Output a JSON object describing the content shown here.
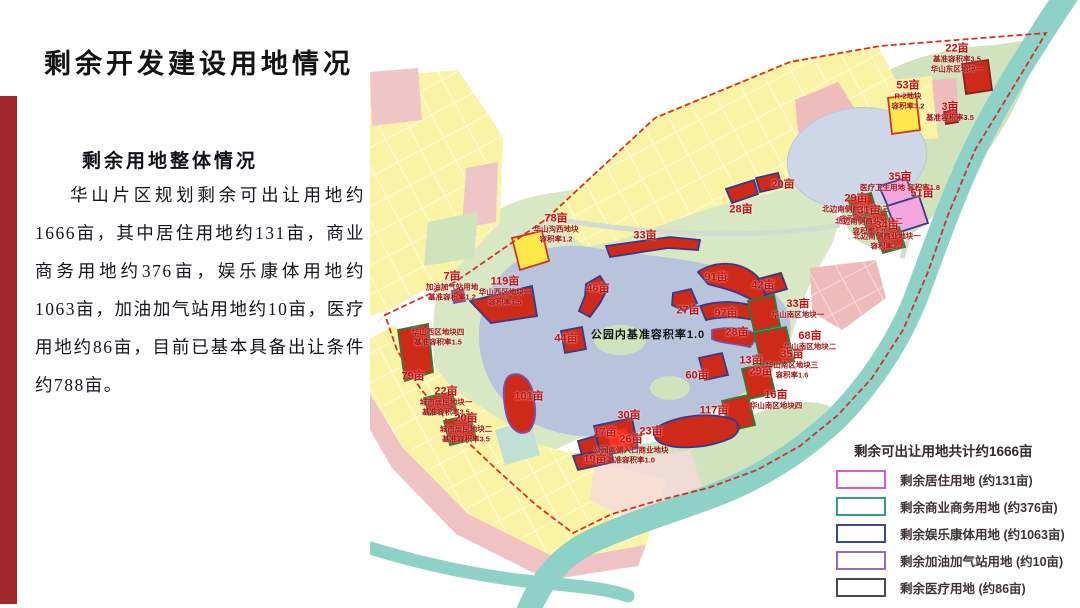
{
  "slide": {
    "title": "剩余开发建设用地情况",
    "subtitle": "剩余用地整体情况",
    "body": "华山片区规划剩余可出让用地约1666亩，其中居住用地约131亩，商业商务用地约376亩，娱乐康体用地约1063亩，加油加气站用地约10亩，医疗用地约86亩，目前已基本具备出让条件约788亩。"
  },
  "map": {
    "center_note": "公园内基准容积率1.0",
    "colors": {
      "remaining_parcel_fill": "#ce2a1a",
      "boundary_dashed": "#d23327",
      "park_green": "#d9e8c4",
      "lake_blue": "#b7c4dc",
      "river_teal": "#8ed1c6",
      "parcel_yellow": "#faf3a6"
    },
    "parcels": [
      {
        "label": "22亩",
        "note": "基准容积率3.5\n华山东区地块一",
        "x": 957,
        "y": 60
      },
      {
        "label": "53亩",
        "note": "R-2地块\n容积率3.2",
        "x": 908,
        "y": 97
      },
      {
        "label": "3亩",
        "note": "基准容积率3.5",
        "x": 950,
        "y": 113
      },
      {
        "label": "20亩",
        "x": 783,
        "y": 185
      },
      {
        "label": "28亩",
        "x": 741,
        "y": 210
      },
      {
        "label": "78亩",
        "note": "华山沟西地块\n容积率1.2",
        "x": 556,
        "y": 230
      },
      {
        "label": "33亩",
        "x": 645,
        "y": 236
      },
      {
        "label": "35亩",
        "note": "医疗卫生用地 容积率1.8",
        "x": 900,
        "y": 183
      },
      {
        "label": "51亩",
        "x": 922,
        "y": 194
      },
      {
        "label": "29亩",
        "note": "北边南侧商业地块三\n容积率2.5",
        "x": 856,
        "y": 210
      },
      {
        "label": "31亩",
        "note": "北边南侧商业地块二\n容积率4.0",
        "x": 869,
        "y": 222
      },
      {
        "label": "34亩",
        "note": "北边南侧商业地块一\n容积率2.7",
        "x": 887,
        "y": 237
      },
      {
        "label": "7亩",
        "note": "加油加气站用地\n基准容积率1.2",
        "x": 452,
        "y": 288
      },
      {
        "label": "119亩",
        "note": "华山西区地块一\n容积率1.5",
        "x": 505,
        "y": 293
      },
      {
        "label": "46亩",
        "x": 598,
        "y": 289
      },
      {
        "label": "91亩",
        "x": 716,
        "y": 278
      },
      {
        "label": "42亩",
        "x": 763,
        "y": 286
      },
      {
        "label": "27亩",
        "x": 688,
        "y": 311
      },
      {
        "label": "97亩",
        "x": 726,
        "y": 314
      },
      {
        "label": "33亩",
        "note": "华山南区地块一",
        "x": 798,
        "y": 310
      },
      {
        "label": "28亩",
        "x": 737,
        "y": 333
      },
      {
        "label": "68亩",
        "note": "华山南区地块二",
        "x": 810,
        "y": 342
      },
      {
        "label": "44亩",
        "x": 566,
        "y": 339
      },
      {
        "label": "13亩",
        "x": 751,
        "y": 361
      },
      {
        "label": "29亩",
        "x": 761,
        "y": 372
      },
      {
        "label": "35亩",
        "note": "华山南区地块三\n容积率1.6",
        "x": 792,
        "y": 366
      },
      {
        "label": "60亩",
        "x": 697,
        "y": 376
      },
      {
        "label": "101亩",
        "x": 529,
        "y": 397
      },
      {
        "label": "16亩",
        "note": "华山南区地块四",
        "x": 776,
        "y": 401
      },
      {
        "label": "117亩",
        "x": 714,
        "y": 411
      },
      {
        "label": "30亩",
        "x": 629,
        "y": 416
      },
      {
        "label": "17亩",
        "x": 605,
        "y": 433
      },
      {
        "label": "23亩",
        "x": 651,
        "y": 432
      },
      {
        "label": "26亩",
        "note": "公园南侧入口商业地块\n基准容积率1.0",
        "x": 631,
        "y": 451
      },
      {
        "label": "19亩",
        "x": 595,
        "y": 460
      },
      {
        "label": "79亩",
        "x": 413,
        "y": 377
      },
      {
        "label": "22亩",
        "note": "城市居民地块一\n基准容积率3.5",
        "x": 446,
        "y": 403
      },
      {
        "label": "20亩",
        "note": "城市居民地块二\n基准容积率3.5",
        "x": 466,
        "y": 430
      },
      {
        "label": "",
        "note": "华山西区地块四\n基准容积率1.5",
        "x": 438,
        "y": 338
      }
    ]
  },
  "legend": {
    "title": "剩余可出让用地共计约1666亩",
    "items": [
      {
        "label": "剩余居住用地 (约131亩)",
        "color": "#d25fc8"
      },
      {
        "label": "剩余商业商务用地 (约376亩)",
        "color": "#2fa183"
      },
      {
        "label": "剩余娱乐康体用地 (约1063亩)",
        "color": "#3a4a8f"
      },
      {
        "label": "剩余加油加气站用地 (约10亩)",
        "color": "#9a68bd"
      },
      {
        "label": "剩余医疗用地 (约86亩)",
        "color": "#4a4a4a"
      }
    ]
  }
}
